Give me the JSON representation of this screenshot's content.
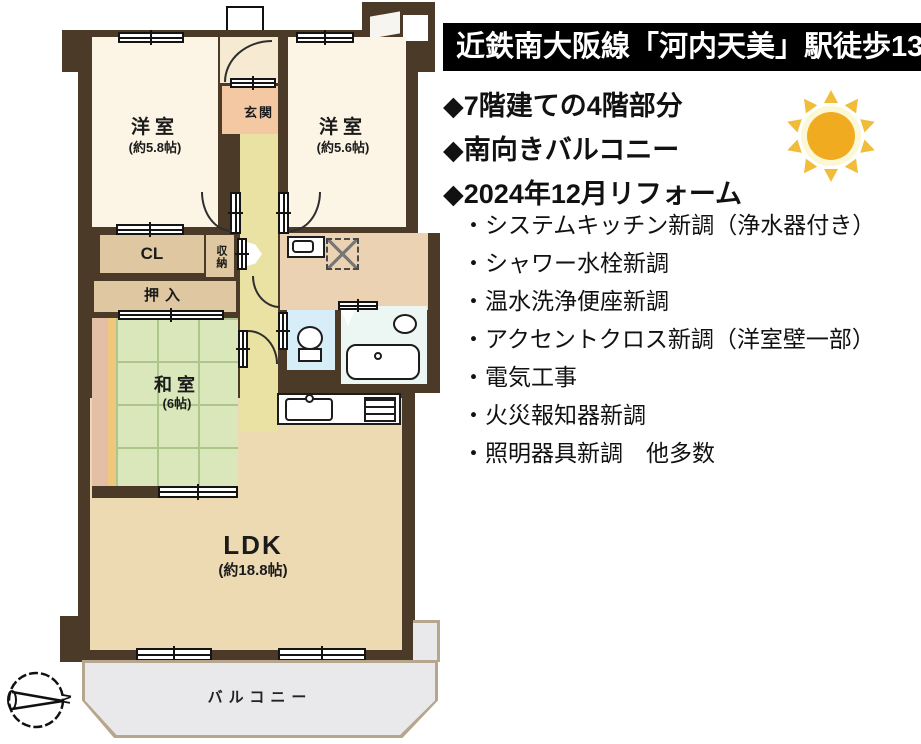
{
  "panel": {
    "header": "近鉄南大阪線「河内天美」駅徒歩13分",
    "features": [
      "◆7階建ての4階部分",
      "◆南向きバルコニー",
      "◆2024年12月リフォーム"
    ],
    "renovations": [
      "・システムキッチン新調（浄水器付き）",
      "・シャワー水栓新調",
      "・温水洗浄便座新調",
      "・アクセントクロス新調（洋室壁一部）",
      "・電気工事",
      "・火災報知器新調",
      "・照明器具新調　他多数"
    ],
    "colors": {
      "header_bg": "#000000",
      "header_text": "#ffffff",
      "sun_core": "#f0ab21",
      "sun_rays": "#f2bc3b",
      "sun_halo": "#fcf7d4"
    }
  },
  "plan": {
    "rooms": {
      "yoshitsu1": {
        "label": "洋室",
        "size": "(約5.8帖)"
      },
      "yoshitsu2": {
        "label": "洋室",
        "size": "(約5.6帖)"
      },
      "genkan": {
        "label": "玄関"
      },
      "cl": {
        "label": "CL"
      },
      "shuno": {
        "label": "収納"
      },
      "oshiire": {
        "label": "押入"
      },
      "washitsu": {
        "label": "和室",
        "size": "(6帖)"
      },
      "ldk": {
        "label": "LDK",
        "size": "(約18.8帖)"
      },
      "balcony": {
        "label": "バルコニー"
      }
    },
    "compass_label": "N",
    "colors": {
      "wall": "#4b3a28",
      "tatami": "#d9e7ba",
      "ldk": "#eedab2",
      "western_room": "#fcf4e4",
      "entrance": "#f4c8a2",
      "corridor": "#eae2a2",
      "closet": "#dfc7a1",
      "toilet": "#d7edf8",
      "bath": "#ecf7f4",
      "washroom": "#ebd2b3",
      "balcony": "#e9e9ec"
    }
  }
}
